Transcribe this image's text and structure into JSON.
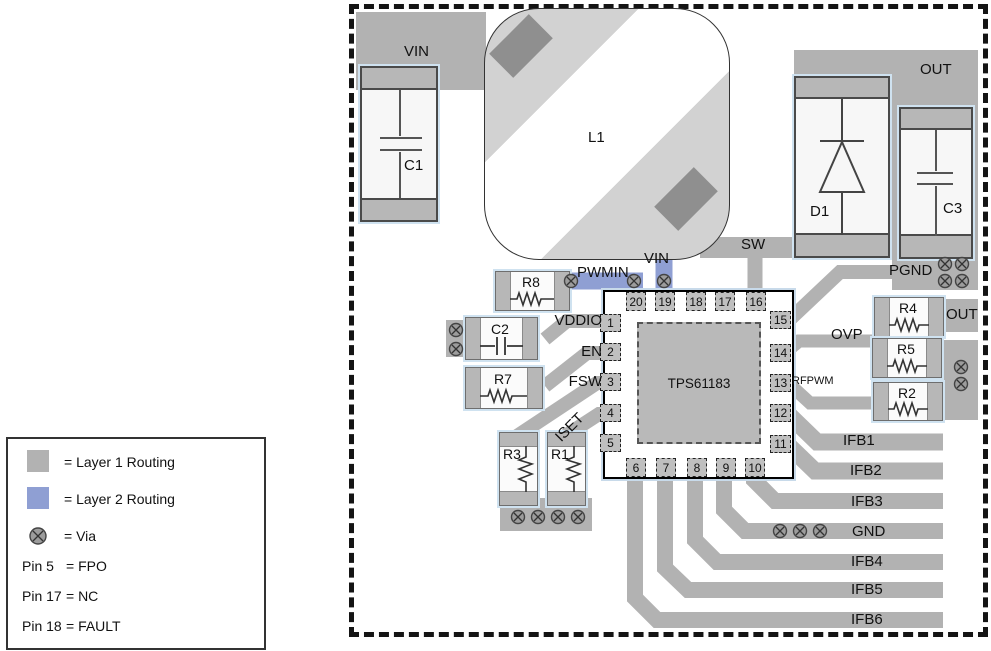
{
  "colors": {
    "layer1": "#b2b2b2",
    "layer2": "#8f9fd3"
  },
  "legend": {
    "layer1": "= Layer 1 Routing",
    "layer2": "= Layer 2 Routing",
    "via": "= Via",
    "pin_notes": [
      {
        "pin": "Pin 5",
        "value": "= FPO"
      },
      {
        "pin": "Pin 17",
        "value": "= NC"
      },
      {
        "pin": "Pin 18",
        "value": "= FAULT"
      }
    ]
  },
  "nets": {
    "vin_top": "VIN",
    "vin_pin19": "VIN",
    "pwmin": "PWMIN",
    "sw": "SW",
    "out_top": "OUT",
    "out_r4": "OUT",
    "pgnd": "PGND",
    "vddio": "VDDIO",
    "en": "EN",
    "fsw": "FSW",
    "iset": "ISET",
    "ovp": "OVP",
    "rfpwm": "RFPWM",
    "right": [
      "IFB1",
      "IFB2",
      "IFB3",
      "GND",
      "IFB4",
      "IFB5",
      "IFB6"
    ]
  },
  "components": {
    "c1": "C1",
    "c2": "C2",
    "c3": "C3",
    "l1": "L1",
    "d1": "D1",
    "r1": "R1",
    "r2": "R2",
    "r3": "R3",
    "r4": "R4",
    "r5": "R5",
    "r7": "R7",
    "r8": "R8"
  },
  "chip": {
    "part": "TPS61183",
    "pins_left": [
      "1",
      "2",
      "3",
      "4",
      "5"
    ],
    "pins_top": [
      "20",
      "19",
      "18",
      "17",
      "16"
    ],
    "pins_right": [
      "15",
      "14",
      "13",
      "12",
      "11"
    ],
    "pins_bottom": [
      "6",
      "7",
      "8",
      "9",
      "10"
    ]
  }
}
